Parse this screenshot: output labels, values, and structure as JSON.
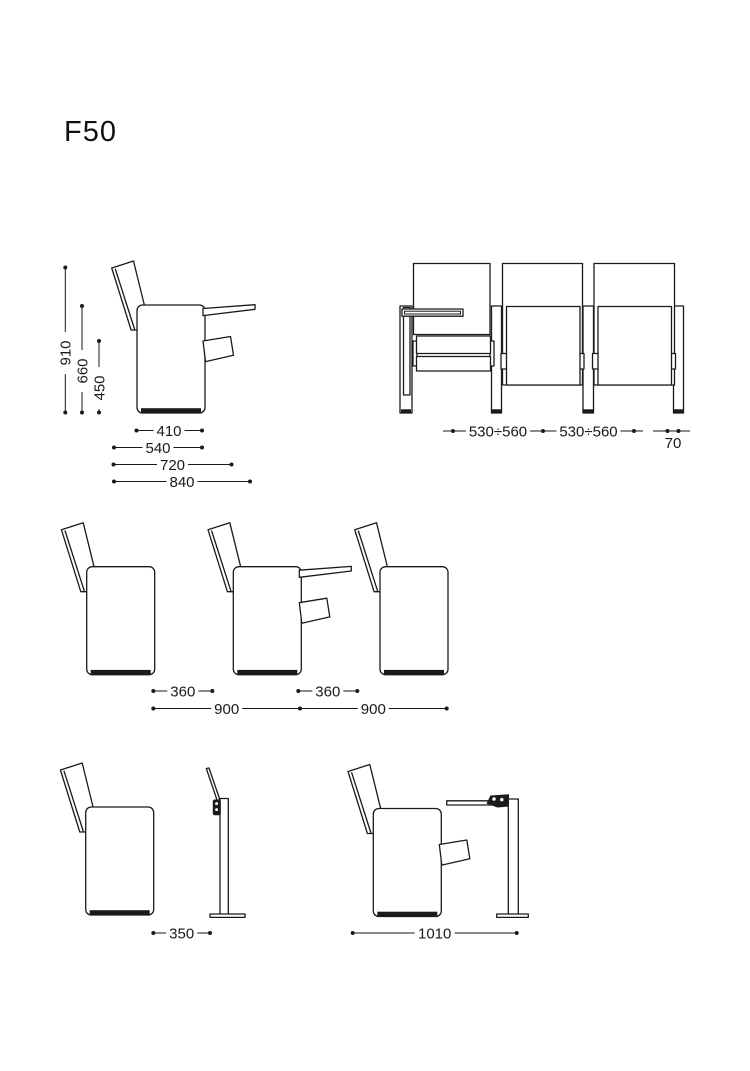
{
  "title": "F50",
  "palette": {
    "ink": "#1a1a1a",
    "paper": "#ffffff"
  },
  "side_view": {
    "height_overall": "910",
    "height_tablet": "660",
    "height_seat": "450",
    "width_seat": "410",
    "depth_closed": "540",
    "depth_seat_open": "720",
    "depth_with_tablet": "840"
  },
  "front_view": {
    "centre_distance_1": "530÷560",
    "centre_distance_2": "530÷560",
    "leg_width": "70"
  },
  "spacing_view": {
    "passage_1": "360",
    "passage_2": "360",
    "row_distance_1": "900",
    "row_distance_2": "900"
  },
  "stand_view": {
    "tablet_folded_distance": "350",
    "tablet_open_distance": "1010"
  }
}
